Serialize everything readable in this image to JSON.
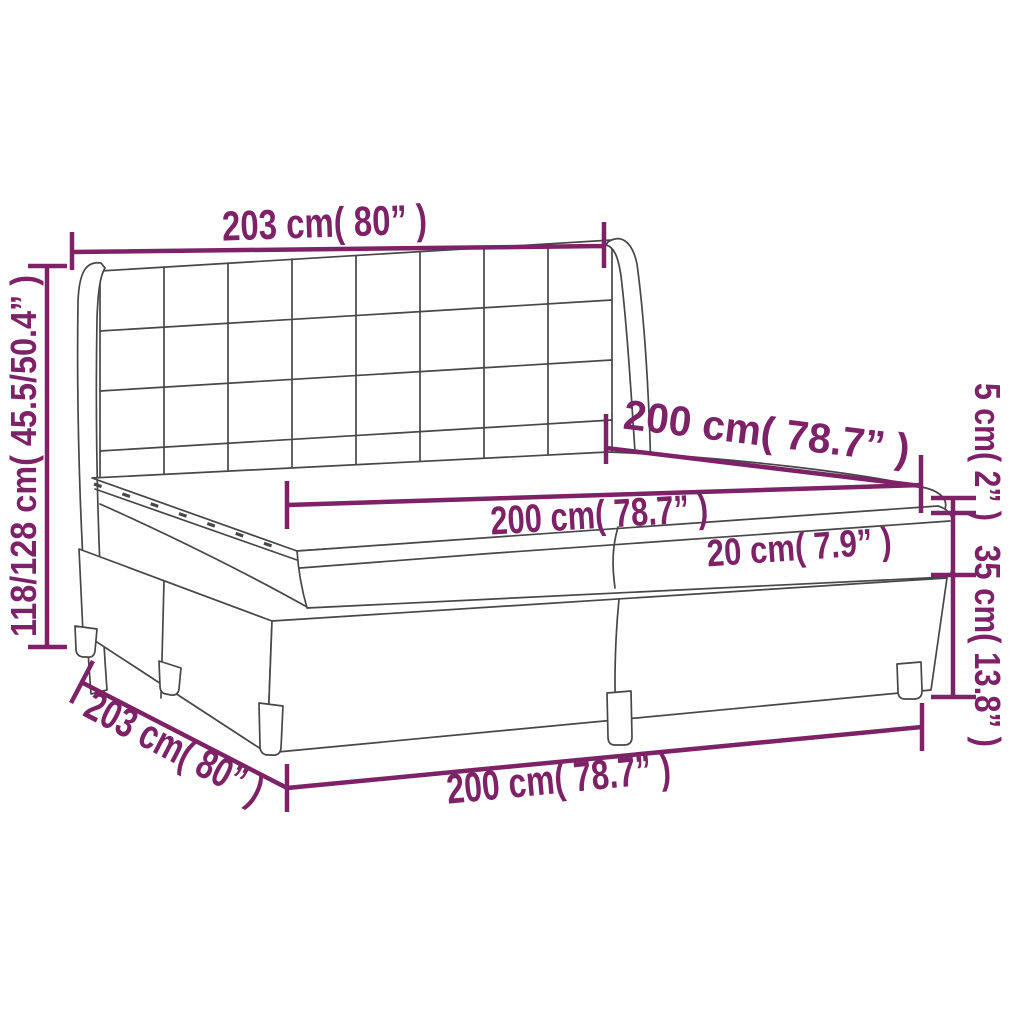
{
  "diagram": {
    "kind": "furniture-dimension-diagram",
    "subject": "box spring bed with winged tufted headboard, two-piece base, mattress and topper",
    "background_color": "#ffffff",
    "accent_color": "#7D2267",
    "drawing_line_color": "#474747",
    "labels": {
      "headboard_width": "203 cm( 80” )",
      "overall_height": "118/128 cm( 45.5/50.4” )",
      "mattress_depth": "200 cm( 78.7” )",
      "mattress_width": "200 cm( 78.7” )",
      "topper_thickness": "5 cm( 2” )",
      "mattress_thickness": "20 cm( 7.9” )",
      "base_height": "35 cm( 13.8” )",
      "base_depth": "203 cm( 80” )",
      "base_width": "200 cm( 78.7” )"
    },
    "values": {
      "headboard_width_cm": 203,
      "headboard_width_in": 80,
      "overall_height_min_cm": 118,
      "overall_height_max_cm": 128,
      "overall_height_min_in": 45.5,
      "overall_height_max_in": 50.4,
      "mattress_depth_cm": 200,
      "mattress_depth_in": 78.7,
      "mattress_width_cm": 200,
      "mattress_width_in": 78.7,
      "topper_thickness_cm": 5,
      "topper_thickness_in": 2,
      "mattress_thickness_cm": 20,
      "mattress_thickness_in": 7.9,
      "base_height_cm": 35,
      "base_height_in": 13.8,
      "base_depth_cm": 203,
      "base_depth_in": 80,
      "base_width_cm": 200,
      "base_width_in": 78.7
    }
  }
}
